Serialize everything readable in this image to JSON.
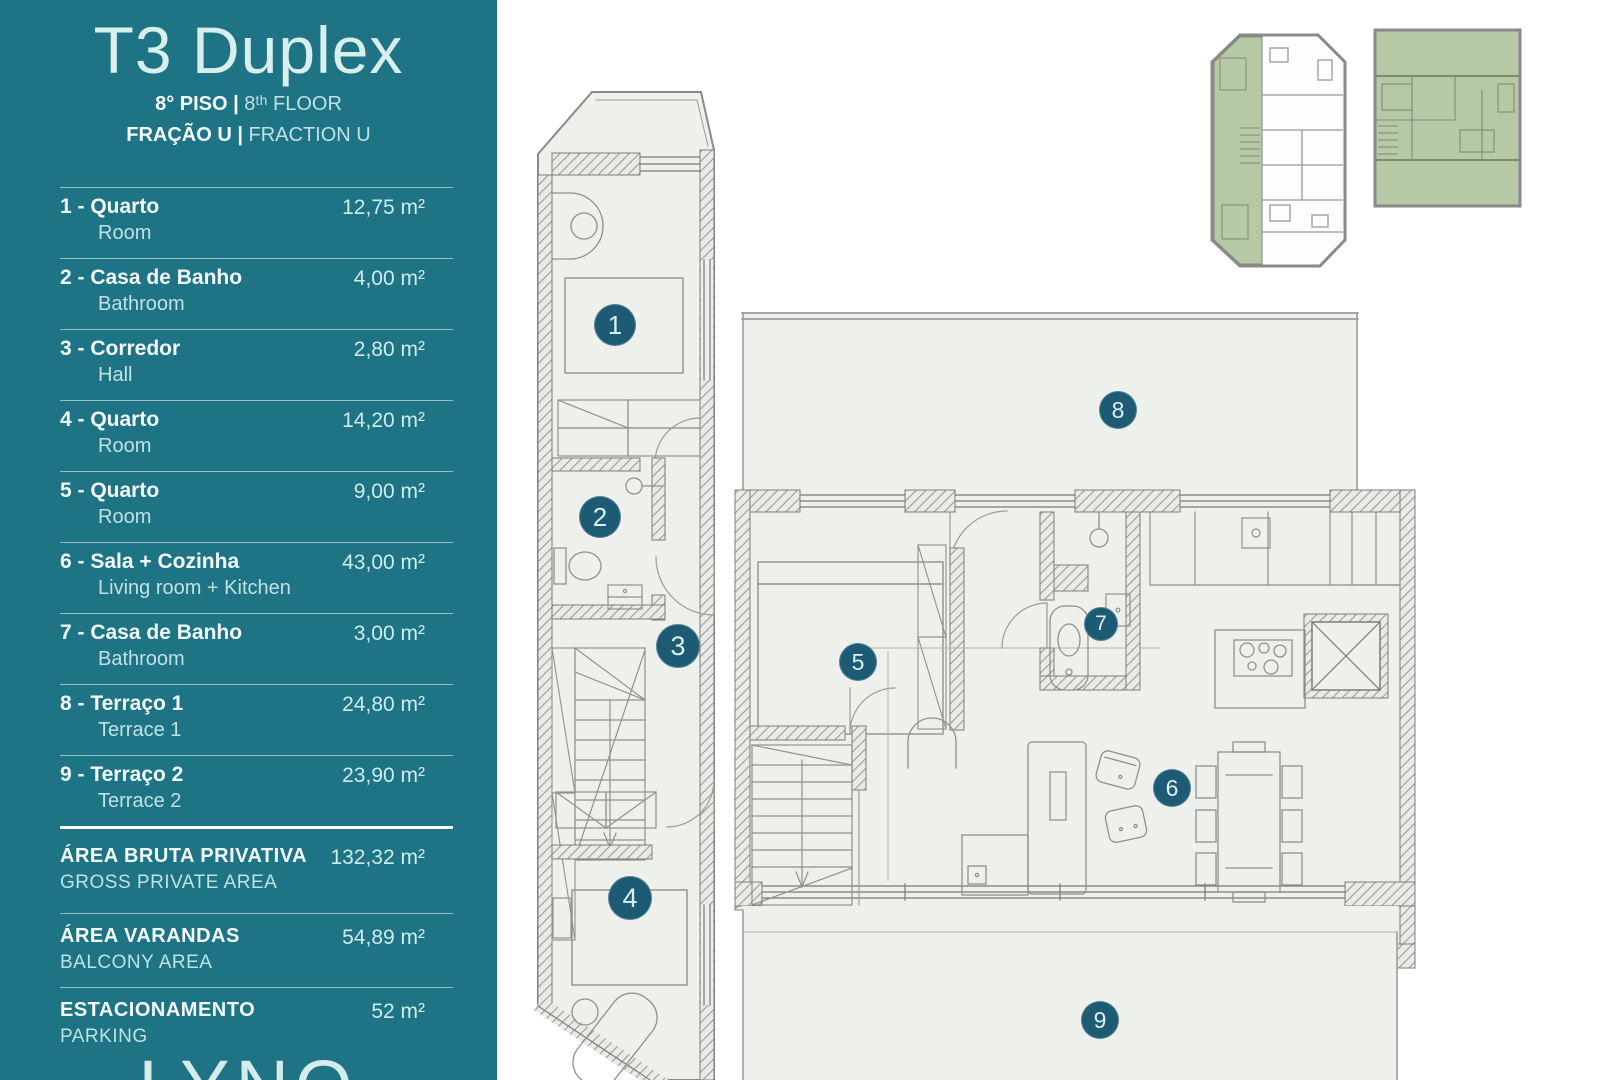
{
  "sidebar": {
    "title": "T3 Duplex",
    "floor_pt": "8° PISO |",
    "floor_en": "8ᵗʰ FLOOR",
    "fraction_pt": "FRAÇÃO U |",
    "fraction_en": "FRACTION U",
    "bg_color": "#1e7384"
  },
  "rooms": [
    {
      "label": "1 - Quarto",
      "sublabel": "Room",
      "area": "12,75 m²"
    },
    {
      "label": "2 - Casa de Banho",
      "sublabel": "Bathroom",
      "area": "4,00 m²"
    },
    {
      "label": "3 - Corredor",
      "sublabel": "Hall",
      "area": "2,80 m²"
    },
    {
      "label": "4 - Quarto",
      "sublabel": "Room",
      "area": "14,20 m²"
    },
    {
      "label": "5 - Quarto",
      "sublabel": "Room",
      "area": "9,00 m²"
    },
    {
      "label": "6 - Sala + Cozinha",
      "sublabel": "Living room + Kitchen",
      "area": "43,00 m²"
    },
    {
      "label": "7 - Casa de Banho",
      "sublabel": "Bathroom",
      "area": "3,00 m²"
    },
    {
      "label": "8 - Terraço 1",
      "sublabel": "Terrace 1",
      "area": "24,80 m²"
    },
    {
      "label": "9 - Terraço 2",
      "sublabel": "Terrace 2",
      "area": "23,90 m²"
    }
  ],
  "totals": [
    {
      "label": "ÁREA BRUTA PRIVATIVA",
      "sublabel": "GROSS PRIVATE AREA",
      "area": "132,32 m²"
    },
    {
      "label": "ÁREA VARANDAS",
      "sublabel": "BALCONY AREA",
      "area": "54,89 m²"
    },
    {
      "label": "ESTACIONAMENTO",
      "sublabel": "PARKING",
      "area": "52 m²"
    }
  ],
  "logo": {
    "text": "LYNQ"
  },
  "plans": {
    "badges": [
      "1",
      "2",
      "3",
      "4",
      "5",
      "6",
      "7",
      "8",
      "9"
    ],
    "badge_color": "#1d5a74",
    "floor_bg": "#eef0eb",
    "wall_gray": "#8a8a8a",
    "highlight_green": "#b7c8a5"
  }
}
